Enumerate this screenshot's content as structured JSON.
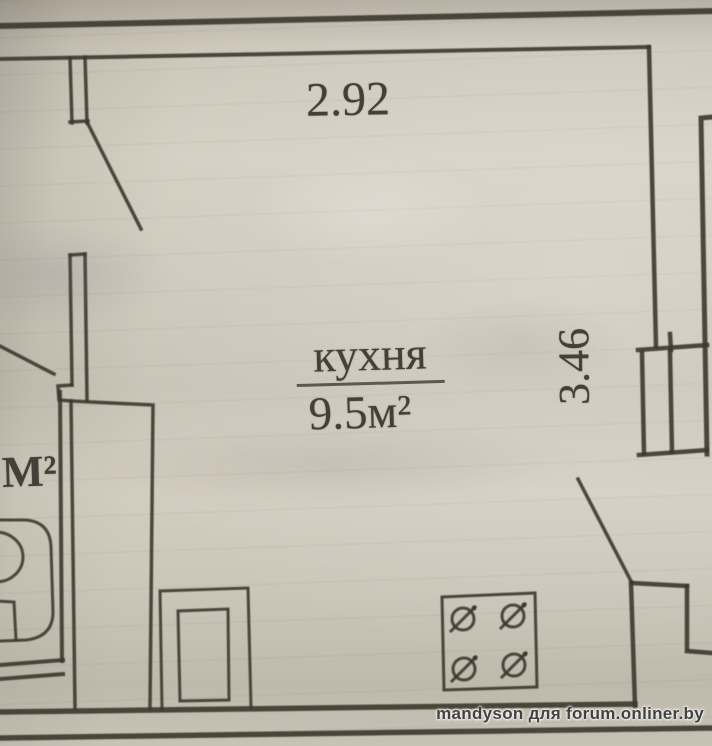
{
  "colors": {
    "paper": "#cfc9bc",
    "ink": "#3c372f",
    "watermark_text": "#424242"
  },
  "plan": {
    "room": {
      "label": "кухня",
      "area": "9.5м²"
    },
    "dimensions": {
      "width": "2.92",
      "height": "3.46"
    },
    "adjacent_room_area": "М²",
    "fixtures": [
      "stove-4-burner",
      "sink",
      "counter",
      "toilet",
      "vent-shaft",
      "door-top-left",
      "door-bathroom",
      "door-bottom-right"
    ]
  },
  "watermark": "mandyson для forum.onliner.by"
}
